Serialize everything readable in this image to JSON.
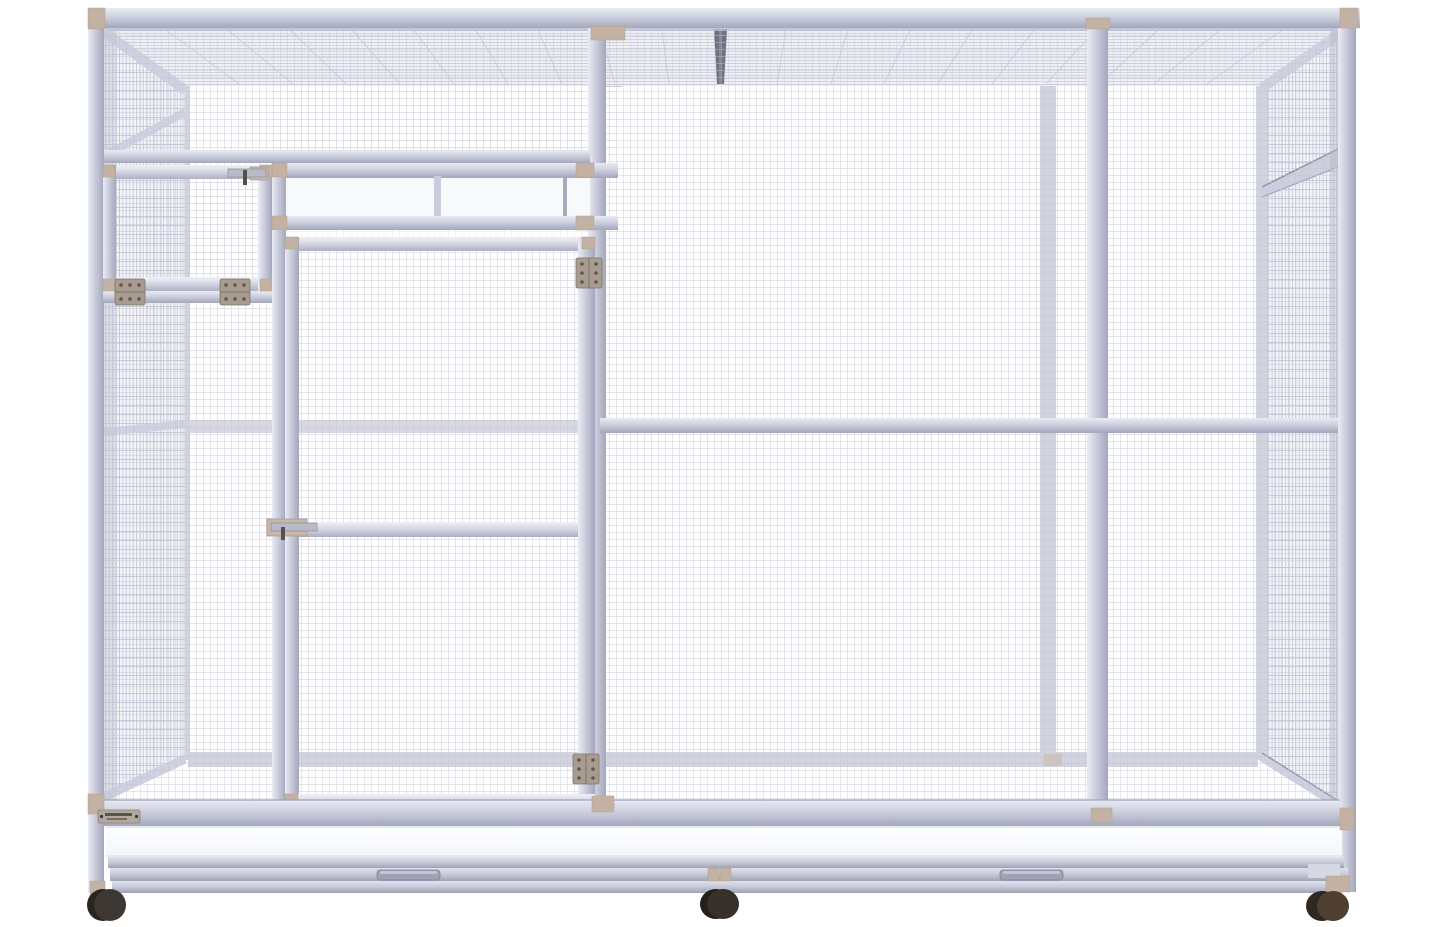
{
  "scene": {
    "description": "3D product render of a large walk-in wire-mesh aviary cage on caster wheels, viewed from the front on a plain white background",
    "text_on_image": "none legible (tiny riveted brand nameplate at lower left is unreadable)"
  },
  "parts": {
    "product": "walk-in wire mesh aviary cage on caster wheels",
    "roof": "wire-mesh roof panel with center seam strip",
    "back_wall": "wire-mesh back wall with mid and bottom rails",
    "left_wall": "wire-mesh left side wall",
    "right_wall": "wire-mesh right side wall with upper transom vent",
    "window": "white sliding-panel transom window above door",
    "escape_hatch": "small upper-left safety door with slide latch and two hinges",
    "main_door": "large hinged mesh entry door with slide latch, mid rail and two hinges",
    "tray": "white pull-out cleaning tray with two handles",
    "base": "rolling base frame with tan corner connectors",
    "wheels": "three dark caster wheels",
    "nameplate": "riveted metal brand nameplate (text illegible)"
  },
  "colors": {
    "background": "#ffffff",
    "frame": "#c9ccdb",
    "frame_light": "#eceef5",
    "frame_shadow": "#a3a7bc",
    "back_frame": "#c6c9d8",
    "mesh_front": "#c2c5d4",
    "mesh_side": "#b6bacd",
    "mesh_back": "#d6d8e2",
    "roof_line": "#c7cad9",
    "roof_seam": "#70737f",
    "connector": "#c3b2a3",
    "hinge": "#a89c90",
    "hinge_screw": "#5f574e",
    "latch": "#b9bac8",
    "latch_bracket": "#c8b6a8",
    "pane": "#f8f9fb",
    "tray": "#fbfcfd",
    "nameplate": "#b3a89d",
    "wheel_left": "#3d3733",
    "wheel_center": "#38302a",
    "wheel_right": "#4f3f30"
  }
}
